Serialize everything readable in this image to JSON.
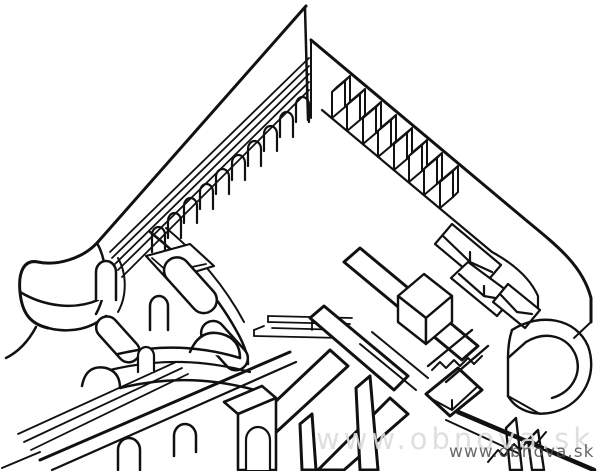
{
  "figure": {
    "name": "bastion-cutaway-drawing",
    "kind": "line-drawing"
  },
  "watermarks": {
    "large": "www.obnova.sk",
    "small": "www.obnova.sk"
  },
  "colors": {
    "bg": "#ffffff",
    "ink": "#111111",
    "watermark-large": "#dcdcdc",
    "watermark-small": "#4f4f4f"
  }
}
